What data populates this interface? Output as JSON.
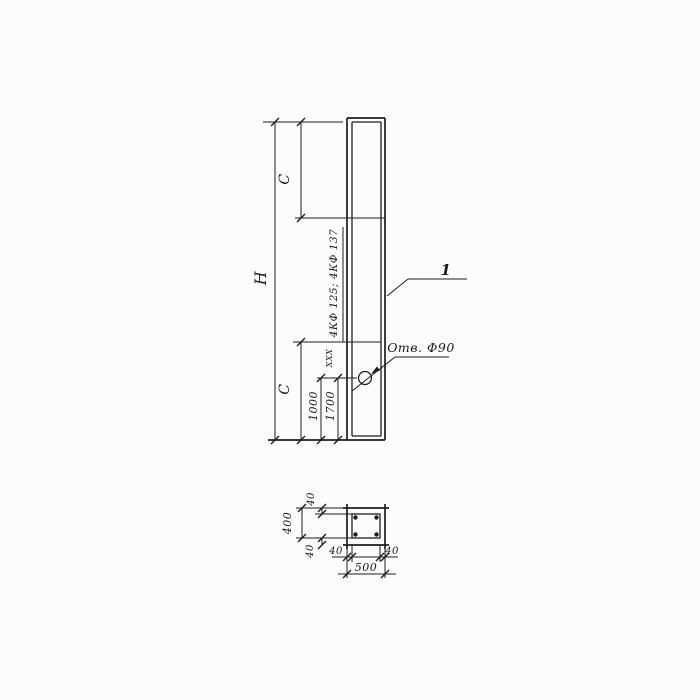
{
  "drawing": {
    "type": "technical-drawing",
    "background_color": "#fcfcfc",
    "ink_color": "#1e1e1e",
    "elevation": {
      "dim_overall_height": "Н",
      "dim_c_top": "С",
      "dim_c_bottom": "С",
      "dim_1000": "1000",
      "dim_1700": "1700",
      "dim_small": "XXX",
      "marks_note": "4КФ 125; 4КФ 137",
      "hole_label": "Отв. Ф90",
      "position_callout": "1"
    },
    "section": {
      "dim_height": "400",
      "dim_cover_top": "40",
      "dim_cover_bottom": "40",
      "dim_cover_left": "40",
      "dim_cover_right": "40",
      "dim_width": "500"
    }
  }
}
